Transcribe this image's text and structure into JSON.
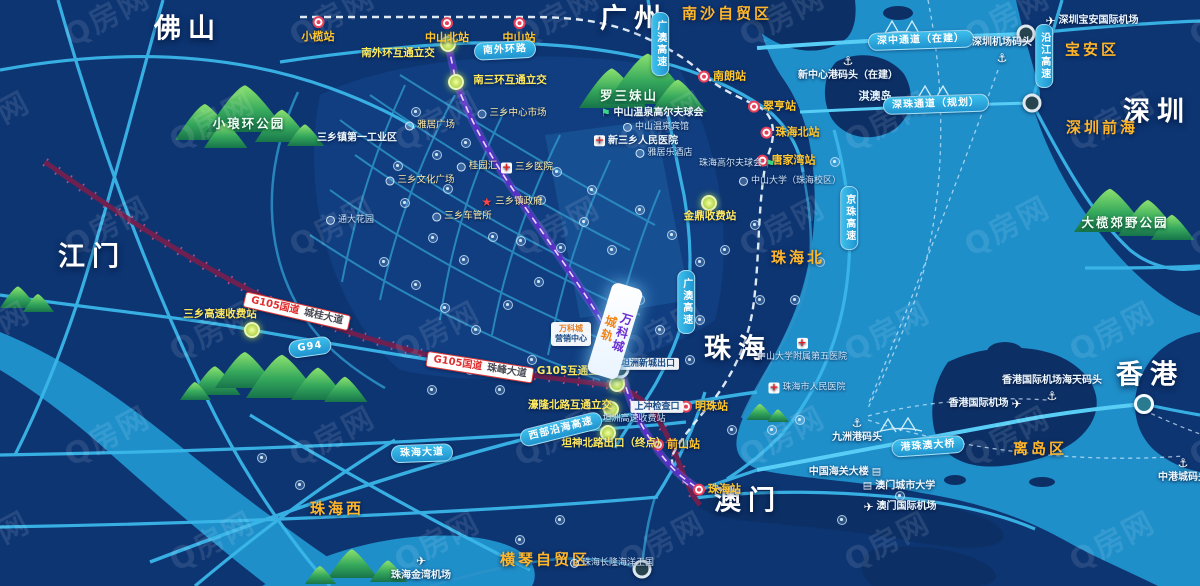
{
  "watermark": {
    "text": "Q房网"
  },
  "palette": {
    "land": "#0d3572",
    "sea": "#1f8fca",
    "road": "#3ab6e9",
    "road_bright": "#58cef6",
    "metro_purple": "#5b2fc8",
    "g105_red": "#6e2150",
    "district_orange": "#ffb62b",
    "interchange_yellow": "#ffe95e",
    "station_orange": "#ffc62e",
    "mountain_green": "#2d9e52"
  },
  "featured": {
    "col1": "城轨",
    "col2": "万科城",
    "info1": "万科城",
    "info2": "营销中心"
  },
  "green_nodes": [
    [
      448,
      44
    ],
    [
      456,
      82
    ],
    [
      252,
      330
    ],
    [
      617,
      384
    ],
    [
      611,
      409
    ],
    [
      608,
      433
    ],
    [
      709,
      203
    ]
  ],
  "portal_nodes": [
    [
      620,
      369
    ],
    [
      642,
      569
    ],
    [
      1026,
      34
    ],
    [
      1032,
      103
    ]
  ],
  "white_nodes": [
    [
      1144,
      404
    ]
  ],
  "poi_dots": [
    [
      416,
      112
    ],
    [
      437,
      155
    ],
    [
      466,
      143
    ],
    [
      448,
      189
    ],
    [
      398,
      166
    ],
    [
      405,
      203
    ],
    [
      433,
      238
    ],
    [
      464,
      260
    ],
    [
      493,
      237
    ],
    [
      521,
      241
    ],
    [
      384,
      262
    ],
    [
      416,
      285
    ],
    [
      445,
      308
    ],
    [
      476,
      330
    ],
    [
      508,
      305
    ],
    [
      539,
      282
    ],
    [
      561,
      248
    ],
    [
      584,
      222
    ],
    [
      541,
      200
    ],
    [
      557,
      172
    ],
    [
      592,
      190
    ],
    [
      612,
      250
    ],
    [
      640,
      300
    ],
    [
      660,
      330
    ],
    [
      700,
      320
    ],
    [
      760,
      300
    ],
    [
      795,
      300
    ],
    [
      820,
      262
    ],
    [
      835,
      162
    ],
    [
      640,
      210
    ],
    [
      672,
      235
    ],
    [
      700,
      262
    ],
    [
      470,
      370
    ],
    [
      432,
      390
    ],
    [
      500,
      390
    ],
    [
      532,
      360
    ],
    [
      690,
      360
    ],
    [
      732,
      430
    ],
    [
      772,
      430
    ],
    [
      800,
      420
    ],
    [
      262,
      458
    ],
    [
      300,
      485
    ],
    [
      520,
      540
    ],
    [
      560,
      520
    ],
    [
      842,
      520
    ],
    [
      900,
      496
    ],
    [
      755,
      225
    ],
    [
      725,
      250
    ]
  ],
  "labels": [
    {
      "type": "city",
      "text": "佛山",
      "x": 188,
      "y": 29
    },
    {
      "type": "city",
      "text": "广州",
      "x": 634,
      "y": 19
    },
    {
      "type": "city",
      "text": "深圳",
      "x": 1157,
      "y": 112
    },
    {
      "type": "city",
      "text": "江门",
      "x": 92,
      "y": 257
    },
    {
      "type": "city",
      "text": "珠海",
      "x": 738,
      "y": 349
    },
    {
      "type": "city",
      "text": "澳门",
      "x": 748,
      "y": 501
    },
    {
      "type": "city",
      "text": "香港",
      "x": 1150,
      "y": 375
    },
    {
      "type": "district",
      "text": "南沙自贸区",
      "x": 727,
      "y": 14
    },
    {
      "type": "district",
      "text": "宝安区",
      "x": 1092,
      "y": 50
    },
    {
      "type": "district",
      "text": "深圳前海",
      "x": 1102,
      "y": 128
    },
    {
      "type": "district",
      "text": "珠海北",
      "x": 798,
      "y": 258
    },
    {
      "type": "district",
      "text": "离岛区",
      "x": 1040,
      "y": 449
    },
    {
      "type": "district",
      "text": "珠海西",
      "x": 337,
      "y": 509
    },
    {
      "type": "district",
      "text": "横琴自贸区",
      "x": 545,
      "y": 560
    },
    {
      "type": "park",
      "text": "小琅环公园",
      "x": 249,
      "y": 124
    },
    {
      "type": "park",
      "text": "罗三妹山",
      "x": 629,
      "y": 96
    },
    {
      "type": "park",
      "text": "大榄郊野公园",
      "x": 1125,
      "y": 223
    },
    {
      "type": "island",
      "text": "淇澳岛",
      "x": 875,
      "y": 97
    },
    {
      "type": "station",
      "text": "小榄站",
      "x": 318,
      "y": 30,
      "icon": "rail",
      "ip": "top"
    },
    {
      "type": "station",
      "text": "中山北站",
      "x": 447,
      "y": 31,
      "icon": "rail",
      "ip": "top"
    },
    {
      "type": "station",
      "text": "中山站",
      "x": 519,
      "y": 31,
      "icon": "rail",
      "ip": "top"
    },
    {
      "type": "station",
      "text": "南朗站",
      "x": 722,
      "y": 77,
      "icon": "rail",
      "ip": "left"
    },
    {
      "type": "station",
      "text": "翠亨站",
      "x": 772,
      "y": 107,
      "icon": "rail",
      "ip": "left"
    },
    {
      "type": "station",
      "text": "珠海北站",
      "x": 790,
      "y": 133,
      "icon": "rail",
      "ip": "left"
    },
    {
      "type": "station",
      "text": "唐家湾站",
      "x": 786,
      "y": 161,
      "icon": "rail",
      "ip": "left"
    },
    {
      "type": "station",
      "text": "明珠站",
      "x": 704,
      "y": 407,
      "icon": "rail",
      "ip": "left"
    },
    {
      "type": "station",
      "text": "前山站",
      "x": 676,
      "y": 445,
      "icon": "rail",
      "ip": "left"
    },
    {
      "type": "station",
      "text": "珠海站",
      "x": 717,
      "y": 490,
      "icon": "rail",
      "ip": "left"
    },
    {
      "type": "inter",
      "text": "南外环互通立交",
      "x": 398,
      "y": 53
    },
    {
      "type": "inter",
      "text": "南三环互通立交",
      "x": 510,
      "y": 80
    },
    {
      "type": "inter",
      "text": "三乡高速收费站",
      "x": 220,
      "y": 314
    },
    {
      "type": "inter",
      "text": "G105互通立交",
      "x": 573,
      "y": 371
    },
    {
      "type": "inter",
      "text": "濠隆北路互通立交",
      "x": 570,
      "y": 405
    },
    {
      "type": "inter",
      "text": "坦神北路出口（终点）",
      "x": 614,
      "y": 443
    },
    {
      "type": "inter",
      "text": "金鼎收费站",
      "x": 710,
      "y": 216
    },
    {
      "type": "ribbon",
      "text": "G94",
      "x": 310,
      "y": 347,
      "rot": -8
    },
    {
      "type": "ribbon",
      "text": "深中通道（在建）",
      "x": 921,
      "y": 40,
      "rot": -2
    },
    {
      "type": "ribbon",
      "text": "深珠通道（规划）",
      "x": 936,
      "y": 104,
      "rot": -2
    },
    {
      "type": "ribbonv",
      "text": "沿江高速",
      "x": 1044,
      "y": 56
    },
    {
      "type": "ribbonv",
      "text": "广澳高速",
      "x": 660,
      "y": 44
    },
    {
      "type": "ribbonv",
      "text": "广澳高速",
      "x": 686,
      "y": 302
    },
    {
      "type": "ribbonv",
      "text": "京珠高速",
      "x": 849,
      "y": 218
    },
    {
      "type": "ribbon",
      "text": "西部沿海高速",
      "x": 561,
      "y": 429,
      "rot": -14
    },
    {
      "type": "ribbon",
      "text": "港珠澳大桥",
      "x": 928,
      "y": 446,
      "rot": -4
    },
    {
      "type": "ribbon",
      "text": "南外环路",
      "x": 505,
      "y": 50,
      "rot": -3
    },
    {
      "type": "ribbon",
      "text": "珠海大道",
      "x": 422,
      "y": 453,
      "rot": -2
    },
    {
      "type": "badge",
      "text": "G105国道",
      "text2": "城桂大道",
      "x": 297,
      "y": 311,
      "rot": 13
    },
    {
      "type": "badge",
      "text": "G105国道",
      "text2": "珠峰大道",
      "x": 480,
      "y": 367,
      "rot": 9
    },
    {
      "type": "white",
      "text": "新中心港码头（在建）",
      "x": 848,
      "y": 68,
      "icon": "anchor",
      "ip": "top"
    },
    {
      "type": "white",
      "text": "深圳机场码头",
      "x": 1002,
      "y": 50,
      "icon": "anchor",
      "ip": "bottom"
    },
    {
      "type": "white",
      "text": "九洲港码头",
      "x": 857,
      "y": 430,
      "icon": "anchor",
      "ip": "top"
    },
    {
      "type": "white",
      "text": "香港国际机场海天码头",
      "x": 1052,
      "y": 388,
      "icon": "anchor",
      "ip": "bottom"
    },
    {
      "type": "white",
      "text": "中港城码头",
      "x": 1183,
      "y": 470,
      "icon": "anchor",
      "ip": "top"
    },
    {
      "type": "white",
      "text": "深圳宝安国际机场",
      "x": 1092,
      "y": 21,
      "icon": "plane",
      "ip": "left"
    },
    {
      "type": "white",
      "text": "香港国际机场",
      "x": 985,
      "y": 404,
      "icon": "plane",
      "ip": "right"
    },
    {
      "type": "white",
      "text": "珠海金湾机场",
      "x": 421,
      "y": 568,
      "icon": "plane",
      "ip": "top"
    },
    {
      "type": "white",
      "text": "澳门国际机场",
      "x": 900,
      "y": 507,
      "icon": "plane",
      "ip": "left"
    },
    {
      "type": "white",
      "text": "中国海关大楼",
      "x": 845,
      "y": 472,
      "icon": "building",
      "ip": "right"
    },
    {
      "type": "white",
      "text": "澳门城市大学",
      "x": 899,
      "y": 486,
      "icon": "building",
      "ip": "left"
    },
    {
      "type": "tiny",
      "text": "珠海长隆海洋王国",
      "x": 612,
      "y": 563,
      "icon": "dot",
      "ip": "left"
    },
    {
      "type": "tiny",
      "text": "中山大学（珠海校区）",
      "x": 790,
      "y": 181,
      "icon": "dot",
      "ip": "left"
    },
    {
      "type": "tiny",
      "text": "珠海高尔夫球会",
      "x": 737,
      "y": 164,
      "icon": "flag",
      "ip": "right"
    },
    {
      "type": "white",
      "text": "中山温泉高尔夫球会",
      "x": 652,
      "y": 113,
      "icon": "flag",
      "ip": "left"
    },
    {
      "type": "tiny",
      "text": "中山温泉宾馆",
      "x": 656,
      "y": 127,
      "icon": "dot",
      "ip": "left"
    },
    {
      "type": "white",
      "text": "新三乡人民医院",
      "x": 636,
      "y": 141,
      "icon": "cross",
      "ip": "left"
    },
    {
      "type": "tiny",
      "text": "雅居乐酒店",
      "x": 664,
      "y": 153,
      "icon": "dot",
      "ip": "left"
    },
    {
      "type": "white",
      "text": "三乡镇第一工业区",
      "x": 357,
      "y": 138
    },
    {
      "type": "tiny",
      "text": "通大花园",
      "x": 350,
      "y": 220,
      "icon": "dot",
      "ip": "left"
    },
    {
      "type": "tiny",
      "text": "中山大学附属第五医院",
      "x": 802,
      "y": 350,
      "icon": "cross",
      "ip": "top"
    },
    {
      "type": "tiny",
      "text": "珠海市人民医院",
      "x": 807,
      "y": 388,
      "icon": "cross",
      "ip": "left"
    },
    {
      "type": "whitebox",
      "text": "上冲检查口",
      "x": 657,
      "y": 407
    },
    {
      "type": "whitebox",
      "text": "坦洲新城出口",
      "x": 648,
      "y": 364
    },
    {
      "type": "tiny",
      "text": "坦洲高速收费站",
      "x": 634,
      "y": 419
    },
    {
      "type": "yellow",
      "text": "雅居广场",
      "x": 430,
      "y": 126,
      "icon": "dot",
      "ip": "left"
    },
    {
      "type": "yellow",
      "text": "三乡中心市场",
      "x": 512,
      "y": 114,
      "icon": "dot",
      "ip": "left"
    },
    {
      "type": "yellow",
      "text": "桂园汇",
      "x": 477,
      "y": 167,
      "icon": "dot",
      "ip": "left"
    },
    {
      "type": "yellow",
      "text": "三乡文化广场",
      "x": 420,
      "y": 181,
      "icon": "dot",
      "ip": "left"
    },
    {
      "type": "yellow",
      "text": "三乡镇政府",
      "x": 512,
      "y": 202,
      "icon": "star",
      "ip": "left"
    },
    {
      "type": "yellow",
      "text": "三乡车管所",
      "x": 462,
      "y": 217,
      "icon": "dot",
      "ip": "left"
    },
    {
      "type": "yellow",
      "text": "三乡医院",
      "x": 527,
      "y": 168,
      "icon": "cross",
      "ip": "left"
    }
  ]
}
